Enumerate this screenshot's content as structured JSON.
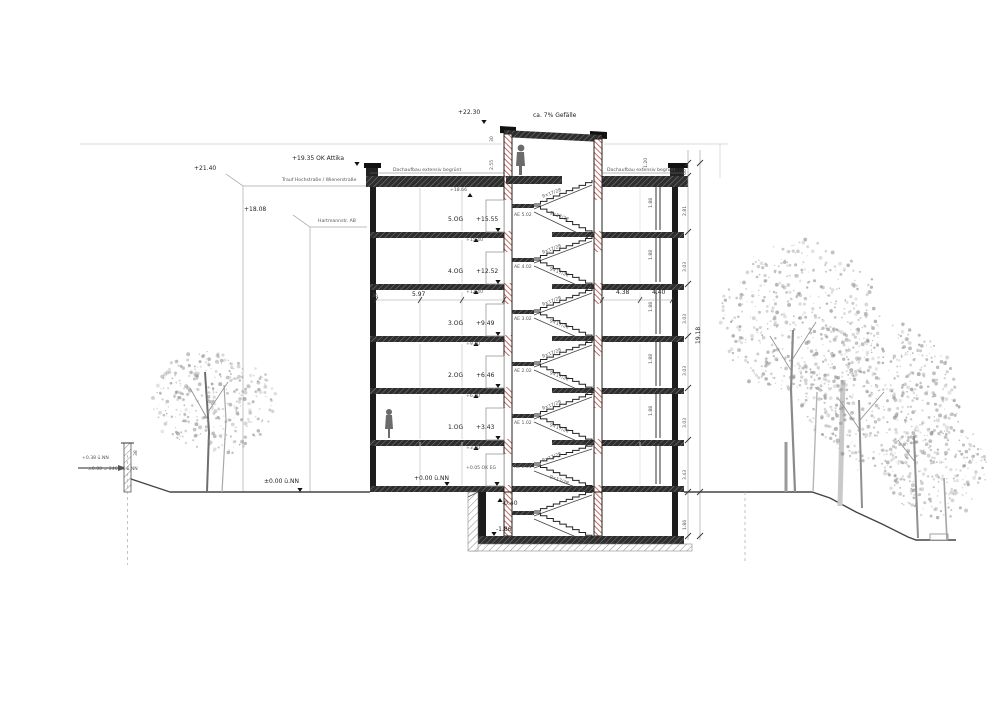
{
  "drawing": {
    "type": "building-section",
    "flight_label": "9×17/28",
    "roof_note": "Dachaufbau extensiv begrünt",
    "tower": {
      "top_level": "+22.30",
      "slope": "ca. 7% Gefälle",
      "dim_a": "30",
      "dim_b": "2.55"
    },
    "attika": "+19.35 OK Attika",
    "roof_soffit": "+18.66",
    "neighbors": [
      {
        "level": "+21.40",
        "name": "Trauf Hochstraße / Wienerstraße"
      },
      {
        "level": "+18.08",
        "name": "Hartmannstr. AB"
      }
    ],
    "floors": [
      {
        "name": "5.OG",
        "ffl": "+15.55",
        "under_slab": "+15.40",
        "door": "AE 5.02",
        "y": 232
      },
      {
        "name": "4.OG",
        "ffl": "+12.52",
        "under_slab": "+12.40",
        "door": "AE 4.02",
        "y": 284
      },
      {
        "name": "3.OG",
        "ffl": "+9.49",
        "under_slab": "+9.40",
        "door": "AE 3.02",
        "y": 336
      },
      {
        "name": "2.OG",
        "ffl": "+6.46",
        "under_slab": "+6.40",
        "door": "AE 2.02",
        "y": 388
      },
      {
        "name": "1.OG",
        "ffl": "+3.43",
        "under_slab": "+3.40",
        "door": "AE 1.02",
        "y": 440
      }
    ],
    "eg": {
      "ffl": "+0.00 ü.NN",
      "ok_eg": "+0.05 OK EG",
      "door": "AE E.01",
      "ground": "±0.00 ü.NN"
    },
    "basement": {
      "below_slab": "-0.40",
      "floor": "-1.86"
    },
    "site_left": {
      "upper": "+0.38 ü.NN",
      "datum": "±0.00 = 246.40 ü.NN",
      "dim": "38"
    },
    "dims": {
      "room_left": "5.97",
      "wall": "36",
      "room_right": "4.38",
      "room_right2": "4.40",
      "window": "1.88",
      "storey": "3.03",
      "storey_top": "2.81",
      "storey_ground": "3.43",
      "parapet": "60",
      "basement": "1.86",
      "overall": "19.18",
      "tower_side": "1.20"
    },
    "colors": {
      "wall_red": "#b5483a",
      "line_dark": "#1c1c1c",
      "tree_gray": "#8f8f8f"
    }
  }
}
